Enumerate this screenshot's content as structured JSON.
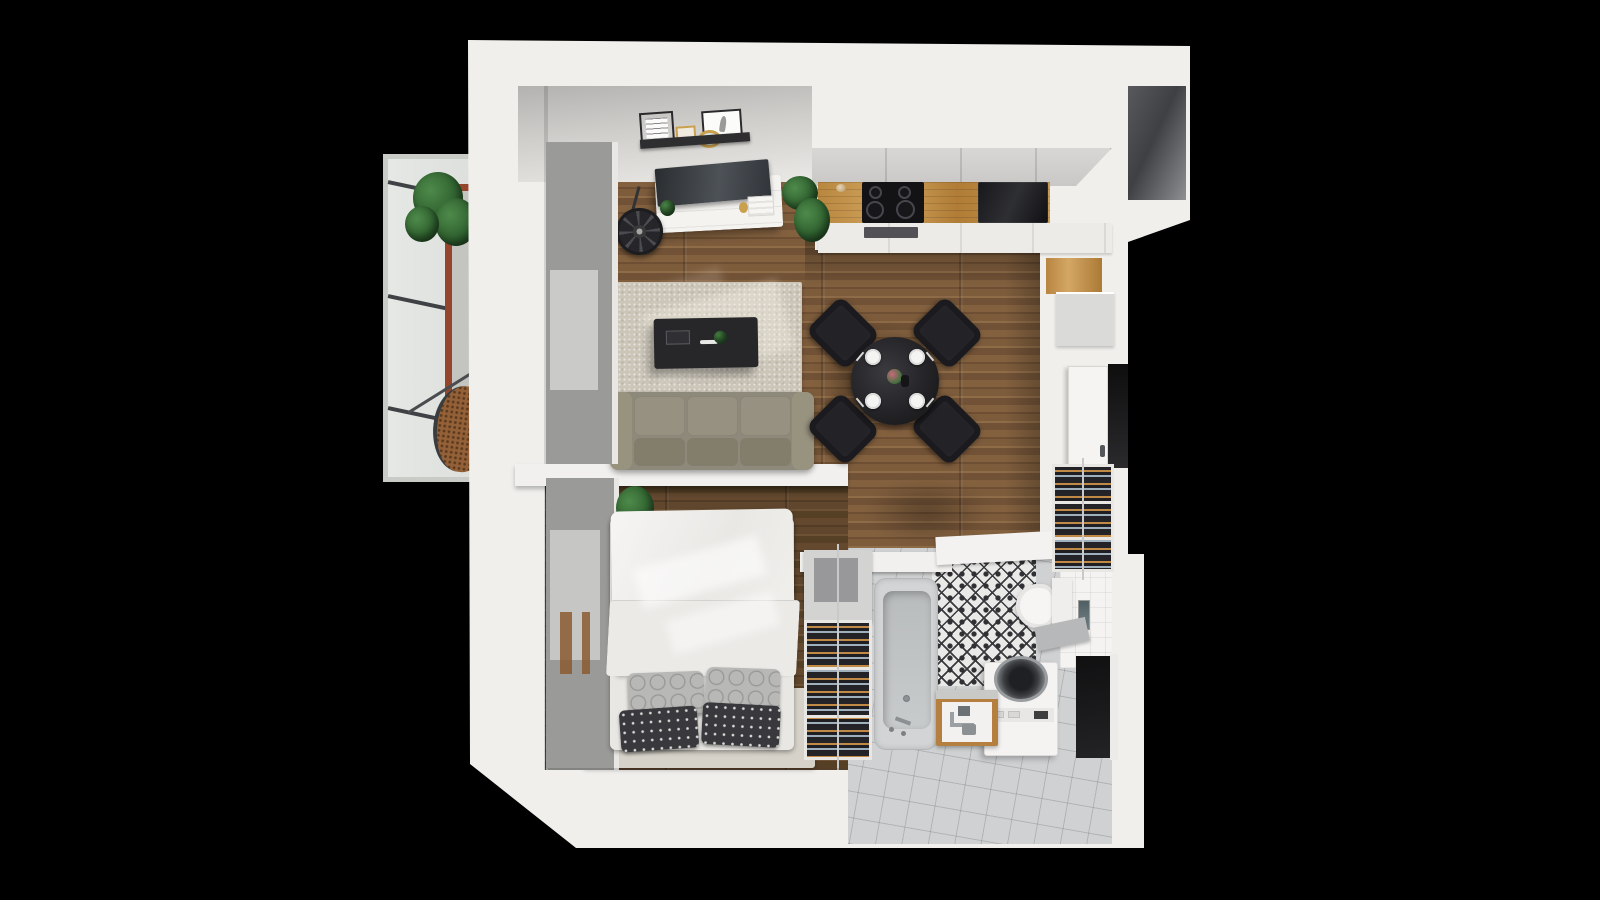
{
  "scene": {
    "type": "3d-floorplan-top-down-render",
    "description": "Photorealistic bird's-eye render of a small one-bedroom apartment on a black background",
    "background_color": "#000000",
    "colors": {
      "walls": "#f0efec",
      "living_wood_floor": "#7a5a3c",
      "bedroom_wood_floor": "#5c452e",
      "bathroom_tile_floor": "#cfd1d2",
      "counter_wood": "#c59a55",
      "terracotta_balcony_trim": "#96452d",
      "sofa": "#8e8a7b",
      "rug": "#ccc6b9",
      "dining_set": "#232327",
      "pattern_tile": "#303034",
      "plant_green": "#2e5f2e",
      "rattan_chair": "#936037"
    }
  },
  "labels": {
    "balcony": "Balcony",
    "living_room": "Living room",
    "kitchen": "Kitchen",
    "dining_area": "Dining area",
    "bedroom": "Bedroom",
    "bathroom": "Bathroom",
    "hallway": "Hallway / entry",
    "sofa": "Three-seat sofa",
    "rug": "Area rug",
    "coffee_table": "Coffee table",
    "tv_console": "TV console with television",
    "picture_ledge": "Picture ledge with framed prints and round mirror",
    "floor_fan": "Floor fan",
    "dining_table": "Round dining table with four place settings",
    "dining_chair": "Dining chair",
    "cooktop": "Induction cooktop",
    "kitchen_sink": "Black kitchen sink",
    "counter": "Wooden countertop",
    "tall_cabinet": "Tall cabinet with wood front",
    "bed": "Double bed with white duvet",
    "pillow": "Pillow",
    "clothes_rack": "Open shelf with folded clothes",
    "shoe_rack": "Hallway shoe rack",
    "wardrobe_door": "Open wardrobe door",
    "bathtub": "Bathtub",
    "toilet": "Wall-hung toilet",
    "washing_machine": "Top-loading washing machine",
    "vanity": "Wood-trimmed sink vanity",
    "mirror": "Wall mirror",
    "egg_chair": "Hanging rattan egg chair",
    "balcony_plant": "Potted plant",
    "window_blinds": "Window blinds",
    "entrance": "Entrance doorway",
    "niche": "Wall niche"
  },
  "inventory": {
    "balcony": [
      "glass-railing",
      "terracotta-trim",
      "potted-plant",
      "hanging-egg-chair"
    ],
    "living_room": [
      "picture-ledge",
      "framed-print-text",
      "framed-print-feather",
      "gold-mini-frame",
      "round-gold-mirror",
      "tv",
      "tv-console",
      "floor-fan",
      "console-plant",
      "large-plant",
      "area-rug",
      "coffee-table",
      "sofa",
      "window-blinds"
    ],
    "kitchen": [
      "upper-cabinets",
      "wooden-countertop",
      "induction-cooktop",
      "oven",
      "black-sink",
      "base-cabinets",
      "tall-cabinet-wood-front",
      "grey-appliance-front"
    ],
    "dining_area": [
      "round-black-table",
      "four-black-chairs",
      "four-plates",
      "cutlery",
      "flower-centerpiece",
      "dark-bottle"
    ],
    "hallway": [
      "shoe-rack",
      "open-wardrobe-door",
      "entrance-niche",
      "dark-doorway"
    ],
    "bedroom": [
      "double-bed",
      "white-duvet",
      "two-ring-pattern-pillows",
      "two-polka-dot-pillows",
      "bed-platform",
      "clothes-shelf",
      "window-blinds",
      "small-plant"
    ],
    "bathroom": [
      "bathtub",
      "tub-faucet",
      "patterned-tile-wall",
      "wall-hung-toilet",
      "grey-shelf",
      "white-tile-wall",
      "wall-mirror",
      "washing-machine",
      "sink-vanity",
      "grey-tile-floor"
    ]
  },
  "counts": {
    "dining_chairs": 4,
    "plates": 4,
    "cooktop_burners": 4,
    "bed_pillows": 4,
    "sofa_seats": 3
  }
}
